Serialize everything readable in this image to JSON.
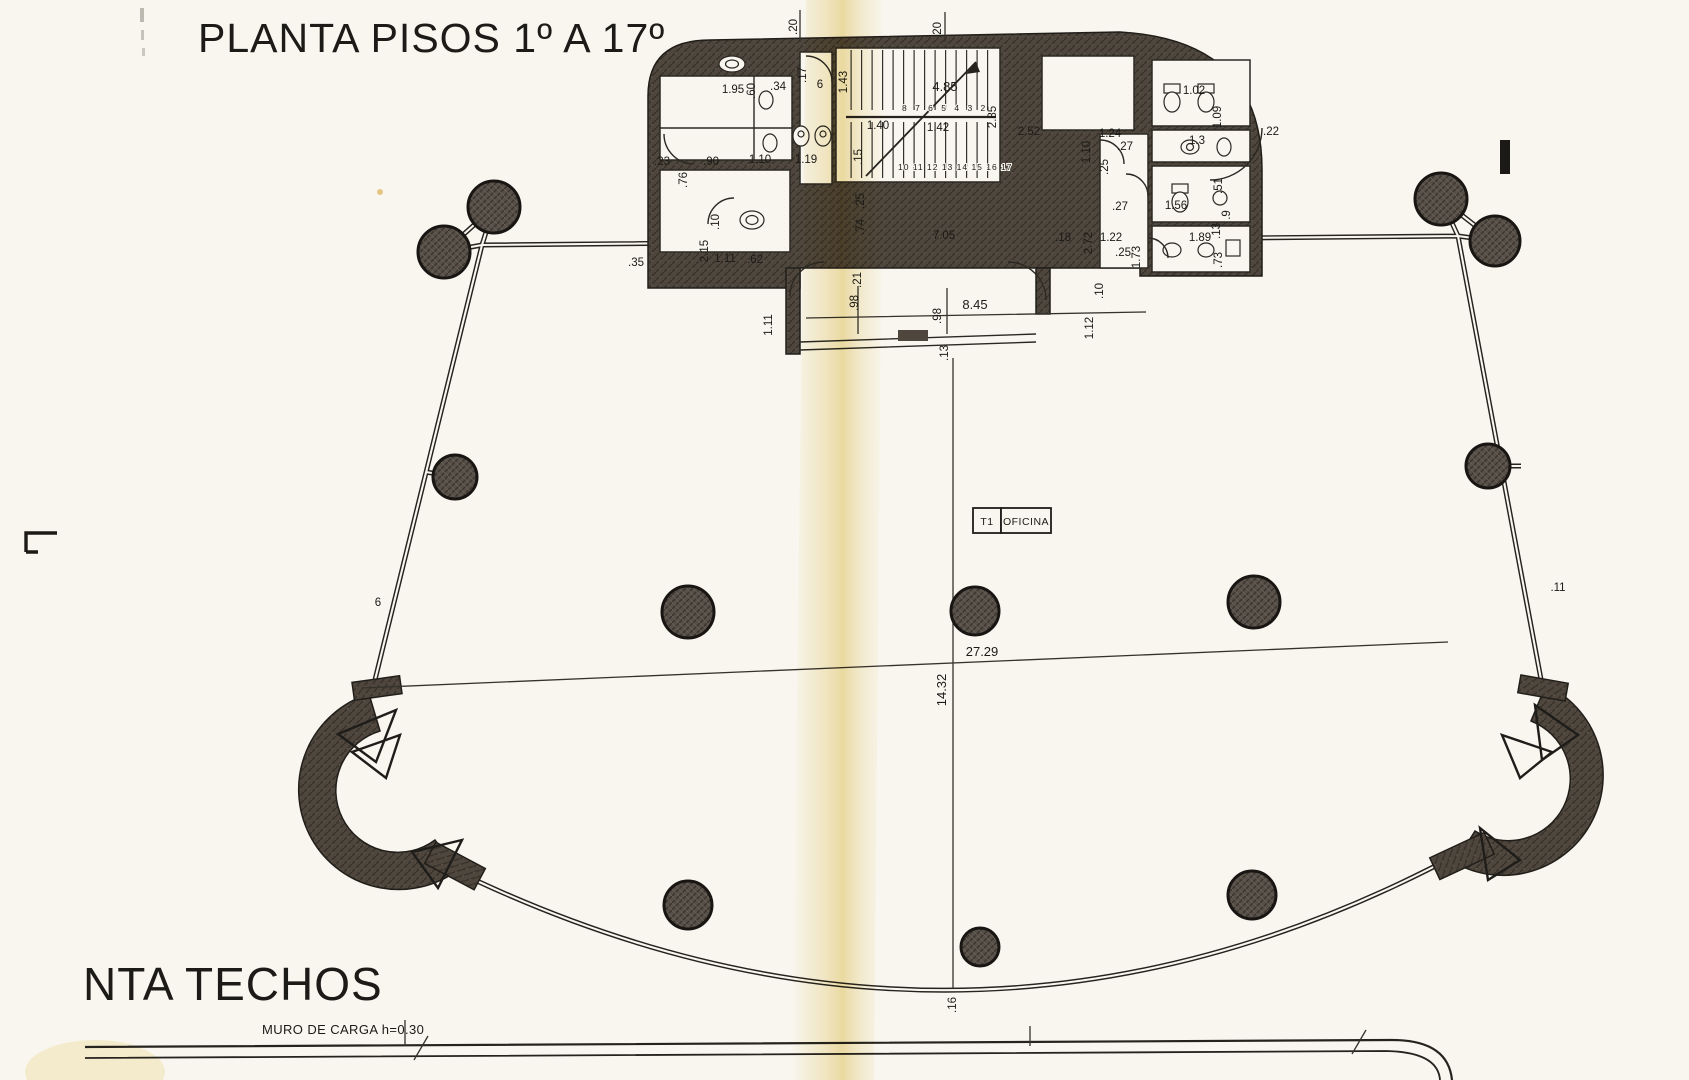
{
  "titles": {
    "main": "PLANTA PISOS 1º A 17º",
    "secondary": "NTA TECHOS",
    "muro_note": "MURO DE CARGA h=0.30"
  },
  "unit_box": {
    "tag": "T1",
    "label": "OFICINA"
  },
  "stairs": {
    "upper_steps": "8 7 6 5 4 3 2",
    "lower_steps": "10 11 12 13 14 15 16 17"
  },
  "bathrooms": [
    {
      "tag": "T2",
      "label": "BAÑO",
      "x": 694,
      "y": 101,
      "tag_w": 16,
      "label_w": 42,
      "h": 18
    },
    {
      "tag": "T3",
      "label": "BAÑO",
      "x": 694,
      "y": 133,
      "tag_w": 16,
      "label_w": 44,
      "h": 18
    },
    {
      "tag": "T4",
      "label": "BAÑO",
      "x": 1154,
      "y": 66,
      "tag_w": 20,
      "label_w": 44,
      "h": 19
    },
    {
      "tag": "T5",
      "label": "BAÑO",
      "x": 1154,
      "y": 170,
      "tag_w": 20,
      "label_w": 44,
      "h": 19
    }
  ],
  "dimension_labels": [
    {
      "t": ".20",
      "x": 797,
      "y": 27,
      "r": -90
    },
    {
      "t": ".20",
      "x": 941,
      "y": 30,
      "r": -90
    },
    {
      "t": "1.95",
      "x": 733,
      "y": 93
    },
    {
      "t": ".60",
      "x": 755,
      "y": 91,
      "r": -90
    },
    {
      "t": ".34",
      "x": 778,
      "y": 90
    },
    {
      "t": ".17",
      "x": 806,
      "y": 75,
      "r": -90
    },
    {
      "t": "6",
      "x": 820,
      "y": 88
    },
    {
      "t": "1.43",
      "x": 847,
      "y": 82,
      "r": -90
    },
    {
      "t": "4.85",
      "x": 945,
      "y": 91,
      "big": true
    },
    {
      "t": "2.85",
      "x": 996,
      "y": 117,
      "r": -90
    },
    {
      "t": "1.40",
      "x": 878,
      "y": 129
    },
    {
      "t": "1.42",
      "x": 938,
      "y": 131
    },
    {
      "t": "2.52",
      "x": 1029,
      "y": 135
    },
    {
      "t": ".15",
      "x": 862,
      "y": 157,
      "r": -90
    },
    {
      "t": "1.19",
      "x": 806,
      "y": 163
    },
    {
      "t": ".23",
      "x": 662,
      "y": 165
    },
    {
      "t": ".90",
      "x": 711,
      "y": 165
    },
    {
      "t": "1.10",
      "x": 760,
      "y": 163
    },
    {
      "t": ".76",
      "x": 687,
      "y": 180,
      "r": -90
    },
    {
      "t": ".10",
      "x": 719,
      "y": 222,
      "r": -90
    },
    {
      "t": "2.15",
      "x": 708,
      "y": 251,
      "r": -90
    },
    {
      "t": "1.11",
      "x": 725,
      "y": 262
    },
    {
      "t": ".62",
      "x": 755,
      "y": 263
    },
    {
      "t": ".35",
      "x": 636,
      "y": 266
    },
    {
      "t": "7.05",
      "x": 944,
      "y": 239
    },
    {
      "t": ".25",
      "x": 864,
      "y": 201,
      "r": -90
    },
    {
      "t": ".74",
      "x": 864,
      "y": 227,
      "r": -90
    },
    {
      "t": "1.02",
      "x": 1194,
      "y": 94
    },
    {
      "t": "1.09",
      "x": 1221,
      "y": 117,
      "r": -90
    },
    {
      "t": "1.3",
      "x": 1197,
      "y": 144
    },
    {
      "t": ".22",
      "x": 1271,
      "y": 135
    },
    {
      "t": "1.24",
      "x": 1110,
      "y": 137
    },
    {
      "t": ".27",
      "x": 1125,
      "y": 150
    },
    {
      "t": "1.10",
      "x": 1090,
      "y": 152,
      "r": -90
    },
    {
      "t": ".25",
      "x": 1108,
      "y": 167,
      "r": -90
    },
    {
      "t": ".51",
      "x": 1222,
      "y": 186,
      "r": -90
    },
    {
      "t": ".27",
      "x": 1120,
      "y": 210
    },
    {
      "t": "1.56",
      "x": 1176,
      "y": 209
    },
    {
      "t": ".9",
      "x": 1230,
      "y": 215,
      "r": -90
    },
    {
      "t": ".13",
      "x": 1220,
      "y": 231,
      "r": -90
    },
    {
      "t": "2.72",
      "x": 1092,
      "y": 243,
      "r": -90
    },
    {
      "t": "1.22",
      "x": 1111,
      "y": 241
    },
    {
      "t": "1.89",
      "x": 1200,
      "y": 241
    },
    {
      "t": ".25",
      "x": 1123,
      "y": 256
    },
    {
      "t": "1.73",
      "x": 1140,
      "y": 257,
      "r": -90
    },
    {
      "t": ".73",
      "x": 1222,
      "y": 260,
      "r": -90
    },
    {
      "t": ".18",
      "x": 1063,
      "y": 241
    },
    {
      "t": ".10",
      "x": 1103,
      "y": 291,
      "r": -90
    },
    {
      "t": "1.12",
      "x": 1093,
      "y": 328,
      "r": -90
    },
    {
      "t": "1.11",
      "x": 772,
      "y": 325,
      "r": -90
    },
    {
      "t": ".21",
      "x": 861,
      "y": 280,
      "r": -90
    },
    {
      "t": ".98",
      "x": 858,
      "y": 303,
      "r": -90
    },
    {
      "t": ".98",
      "x": 941,
      "y": 316,
      "r": -90
    },
    {
      "t": "8.45",
      "x": 975,
      "y": 309,
      "big": true
    },
    {
      "t": ".13",
      "x": 948,
      "y": 353,
      "r": -90
    },
    {
      "t": "27.29",
      "x": 982,
      "y": 656,
      "big": true
    },
    {
      "t": "14.32",
      "x": 946,
      "y": 690,
      "r": -90,
      "big": true
    },
    {
      "t": ".16",
      "x": 956,
      "y": 1005,
      "r": -90
    },
    {
      "t": "6",
      "x": 378,
      "y": 606
    },
    {
      "t": ".11",
      "x": 1558,
      "y": 591
    }
  ],
  "columns": [
    {
      "x": 494,
      "y": 207,
      "rad": 26
    },
    {
      "x": 444,
      "y": 252,
      "rad": 26
    },
    {
      "x": 1441,
      "y": 199,
      "rad": 26
    },
    {
      "x": 1495,
      "y": 241,
      "rad": 25
    },
    {
      "x": 455,
      "y": 477,
      "rad": 22
    },
    {
      "x": 1488,
      "y": 466,
      "rad": 22
    },
    {
      "x": 688,
      "y": 612,
      "rad": 26
    },
    {
      "x": 975,
      "y": 611,
      "rad": 24
    },
    {
      "x": 1254,
      "y": 602,
      "rad": 26
    },
    {
      "x": 688,
      "y": 905,
      "rad": 24
    },
    {
      "x": 980,
      "y": 947,
      "rad": 19
    },
    {
      "x": 1252,
      "y": 895,
      "rad": 24
    }
  ],
  "dashed_boxes": [
    {
      "x": 585,
      "y": 228,
      "w": 66,
      "h": 26,
      "a": 0
    },
    {
      "x": 1352,
      "y": 224,
      "w": 66,
      "h": 26,
      "a": 0
    },
    {
      "x": 415,
      "y": 404,
      "w": 28,
      "h": 62,
      "a": -14
    },
    {
      "x": 378,
      "y": 596,
      "w": 28,
      "h": 66,
      "a": -14
    },
    {
      "x": 1512,
      "y": 394,
      "w": 28,
      "h": 60,
      "a": 11
    },
    {
      "x": 1556,
      "y": 586,
      "w": 28,
      "h": 64,
      "a": 11
    },
    {
      "x": 470,
      "y": 908,
      "w": 70,
      "h": 30,
      "a": 25
    },
    {
      "x": 530,
      "y": 931,
      "w": 78,
      "h": 30,
      "a": 22
    },
    {
      "x": 665,
      "y": 977,
      "w": 80,
      "h": 30,
      "a": 15
    },
    {
      "x": 810,
      "y": 1006,
      "w": 80,
      "h": 30,
      "a": 8
    },
    {
      "x": 963,
      "y": 1015,
      "w": 80,
      "h": 30,
      "a": -1
    },
    {
      "x": 1108,
      "y": 1002,
      "w": 80,
      "h": 30,
      "a": -9
    },
    {
      "x": 1251,
      "y": 968,
      "w": 78,
      "h": 30,
      "a": -17
    },
    {
      "x": 1382,
      "y": 918,
      "w": 76,
      "h": 30,
      "a": -24
    }
  ],
  "colors": {
    "paper": "#f8f6ef",
    "ink": "#1c1a17",
    "wall_fill": "#4f473e",
    "fold": "#e9d482"
  }
}
